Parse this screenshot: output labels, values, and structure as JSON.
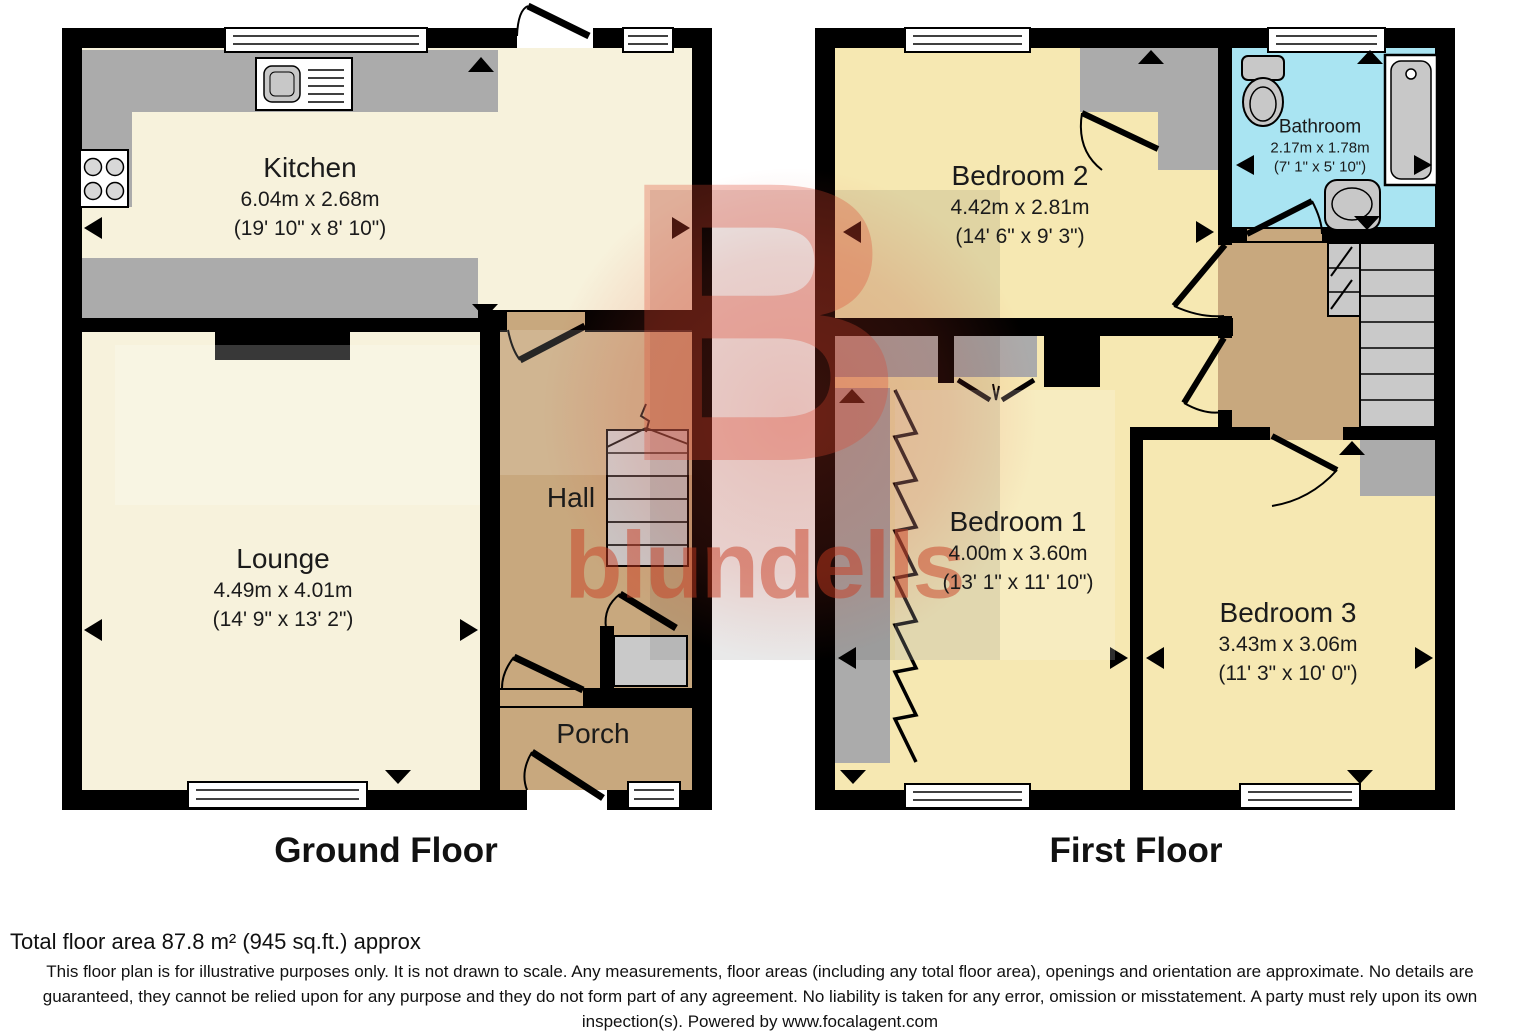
{
  "watermark": {
    "letter": "B",
    "brand": "blundells",
    "color": "#E0452F"
  },
  "ground_floor": {
    "title": "Ground Floor",
    "rooms": {
      "kitchen": {
        "name": "Kitchen",
        "metric": "6.04m x 2.68m",
        "imperial": "(19' 10\" x 8' 10\")"
      },
      "lounge": {
        "name": "Lounge",
        "metric": "4.49m x 4.01m",
        "imperial": "(14' 9\" x 13' 2\")"
      },
      "hall": {
        "name": "Hall"
      },
      "porch": {
        "name": "Porch"
      }
    }
  },
  "first_floor": {
    "title": "First Floor",
    "rooms": {
      "bedroom2": {
        "name": "Bedroom 2",
        "metric": "4.42m x 2.81m",
        "imperial": "(14' 6\" x 9' 3\")"
      },
      "bathroom": {
        "name": "Bathroom",
        "metric": "2.17m x 1.78m",
        "imperial": "(7' 1\" x 5' 10\")"
      },
      "bedroom1": {
        "name": "Bedroom 1",
        "metric": "4.00m x 3.60m",
        "imperial": "(13' 1\" x 11' 10\")"
      },
      "bedroom3": {
        "name": "Bedroom 3",
        "metric": "3.43m x 3.06m",
        "imperial": "(11' 3\" x 10' 0\")"
      }
    }
  },
  "footer": {
    "total_area": "Total floor area 87.8 m² (945 sq.ft.) approx",
    "disclaimer": "This floor plan is for illustrative purposes only. It is not drawn to scale. Any measurements, floor areas (including any total floor area), openings and orientation are approximate. No details are guaranteed, they cannot be relied upon for any purpose and they do not form part of any agreement. No liability is taken for any error, omission or misstatement. A party must rely upon its own inspection(s). Powered by www.focalagent.com"
  },
  "colors": {
    "wall": "#000000",
    "room_cream": "#F7F2DC",
    "room_yellow": "#F6E8B2",
    "hall_tan": "#C8A87E",
    "bathroom_cyan": "#A9E4F2",
    "counter_gray": "#ABABAB",
    "stairs_gray": "#C9C9C9",
    "fixture_gray": "#C8C8C8",
    "watermark_red": "#E0452F"
  }
}
